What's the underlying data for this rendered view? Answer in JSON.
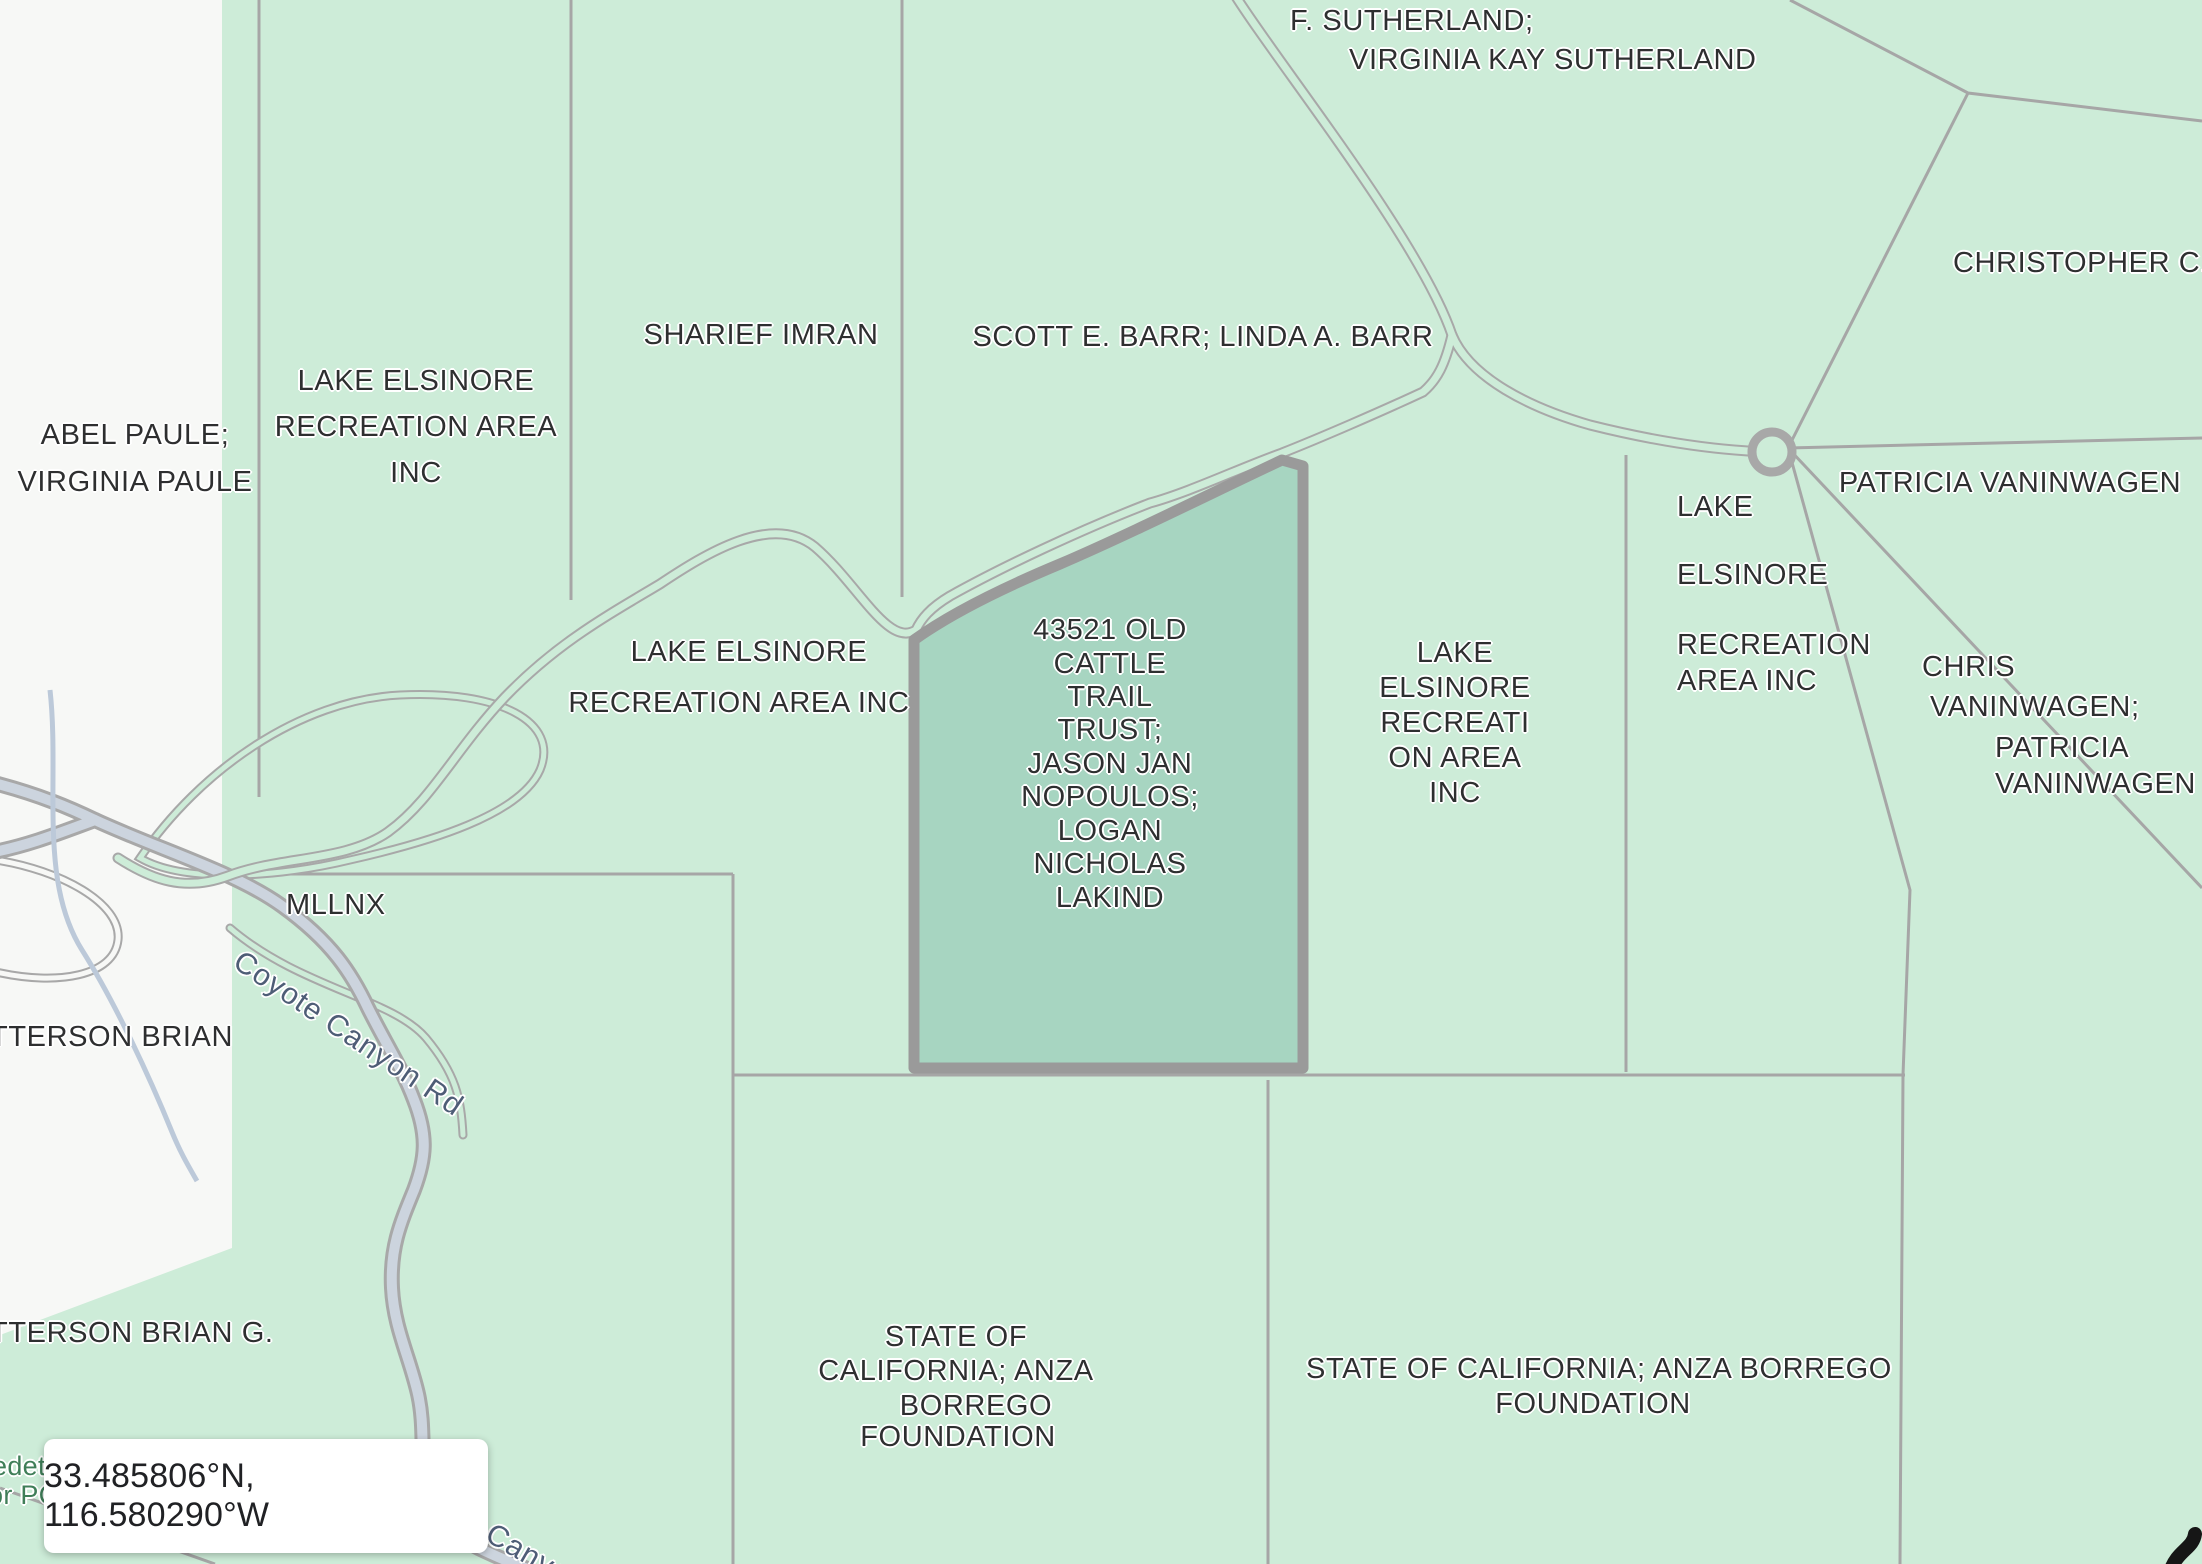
{
  "app": "parcel-map-viewer",
  "coordinate_chip": {
    "text": "33.485806°N, 116.580290°W"
  },
  "selected_parcel": {
    "owner": "43521 OLD CATTLE TRAIL TRUST; JASON JAN NOPOULOS; LOGAN NICHOLAS LAKIND",
    "fill": "#a7d5c1",
    "border": "#9a9a9a"
  },
  "palette": {
    "parcel_green": "#cdecd8",
    "unmapped_white": "#f7f8f6",
    "selected_teal": "#a7d5c1",
    "boundary_line": "#a6a6a6",
    "selected_border": "#9a9a9a",
    "road_fill": "#ccd4de",
    "label_text": "#2e2f30",
    "road_label_text": "#4e5d76",
    "green_label_text": "#3f7e58"
  },
  "road_names": [
    "Coyote Canyon Rd"
  ],
  "labels": [
    {
      "n": "parcel-label-sutherland-1",
      "t": "F. SUTHERLAND;",
      "x": 1290,
      "y": 6,
      "a": "l"
    },
    {
      "n": "parcel-label-sutherland-2",
      "t": "VIRGINIA KAY SUTHERLAND",
      "x": 1349,
      "y": 45,
      "a": "l"
    },
    {
      "n": "parcel-label-christopher",
      "t": "CHRISTOPHER C.",
      "x": 1953,
      "y": 248,
      "a": "l"
    },
    {
      "n": "parcel-label-abel-paule-1",
      "t": "ABEL PAULE;",
      "x": 135,
      "y": 420,
      "a": "c"
    },
    {
      "n": "parcel-label-abel-paule-2",
      "t": "VIRGINIA PAULE",
      "x": 135,
      "y": 467,
      "a": "c"
    },
    {
      "n": "parcel-label-lera-nw-1",
      "t": "LAKE ELSINORE",
      "x": 416,
      "y": 366,
      "a": "c"
    },
    {
      "n": "parcel-label-lera-nw-2",
      "t": "RECREATION AREA",
      "x": 416,
      "y": 412,
      "a": "c"
    },
    {
      "n": "parcel-label-lera-nw-3",
      "t": "INC",
      "x": 416,
      "y": 458,
      "a": "c"
    },
    {
      "n": "parcel-label-sharief-imran",
      "t": "SHARIEF IMRAN",
      "x": 761,
      "y": 320,
      "a": "c"
    },
    {
      "n": "parcel-label-scott-barr",
      "t": "SCOTT E. BARR; LINDA A. BARR",
      "x": 1203,
      "y": 322,
      "a": "c"
    },
    {
      "n": "parcel-label-patricia-vaninwagen",
      "t": "PATRICIA VANINWAGEN",
      "x": 2010,
      "y": 468,
      "a": "c"
    },
    {
      "n": "parcel-label-lera-e-1",
      "t": "LAKE",
      "x": 1677,
      "y": 492,
      "a": "l"
    },
    {
      "n": "parcel-label-lera-e-2",
      "t": "ELSINORE",
      "x": 1677,
      "y": 560,
      "a": "l"
    },
    {
      "n": "parcel-label-lera-e-3",
      "t": "RECREATION",
      "x": 1677,
      "y": 630,
      "a": "l"
    },
    {
      "n": "parcel-label-lera-e-4",
      "t": "AREA INC",
      "x": 1677,
      "y": 666,
      "a": "l"
    },
    {
      "n": "parcel-label-chris-vaninwagen-1",
      "t": "CHRIS",
      "x": 1922,
      "y": 652,
      "a": "l"
    },
    {
      "n": "parcel-label-chris-vaninwagen-2",
      "t": "VANINWAGEN;",
      "x": 1930,
      "y": 692,
      "a": "l"
    },
    {
      "n": "parcel-label-chris-vaninwagen-3",
      "t": "PATRICIA",
      "x": 1995,
      "y": 733,
      "a": "l"
    },
    {
      "n": "parcel-label-chris-vaninwagen-4",
      "t": "VANINWAGEN",
      "x": 1995,
      "y": 769,
      "a": "l"
    },
    {
      "n": "parcel-label-lera-mid-1",
      "t": "LAKE",
      "x": 1455,
      "y": 638,
      "a": "c"
    },
    {
      "n": "parcel-label-lera-mid-2",
      "t": "ELSINORE",
      "x": 1455,
      "y": 673,
      "a": "c"
    },
    {
      "n": "parcel-label-lera-mid-3",
      "t": "RECREATI",
      "x": 1455,
      "y": 708,
      "a": "c"
    },
    {
      "n": "parcel-label-lera-mid-4",
      "t": "ON AREA",
      "x": 1455,
      "y": 743,
      "a": "c"
    },
    {
      "n": "parcel-label-lera-mid-5",
      "t": "INC",
      "x": 1455,
      "y": 778,
      "a": "c"
    },
    {
      "n": "parcel-label-lera-w-1",
      "t": "LAKE ELSINORE",
      "x": 749,
      "y": 637,
      "a": "c"
    },
    {
      "n": "parcel-label-lera-w-2",
      "t": "RECREATION AREA INC",
      "x": 739,
      "y": 688,
      "a": "c"
    },
    {
      "n": "selected-parcel-label-1",
      "t": "43521 OLD",
      "x": 1110,
      "y": 615,
      "a": "c"
    },
    {
      "n": "selected-parcel-label-2",
      "t": "CATTLE",
      "x": 1110,
      "y": 649,
      "a": "c"
    },
    {
      "n": "selected-parcel-label-3",
      "t": "TRAIL",
      "x": 1110,
      "y": 682,
      "a": "c"
    },
    {
      "n": "selected-parcel-label-4",
      "t": "TRUST;",
      "x": 1110,
      "y": 715,
      "a": "c"
    },
    {
      "n": "selected-parcel-label-5",
      "t": "JASON JAN",
      "x": 1110,
      "y": 749,
      "a": "c"
    },
    {
      "n": "selected-parcel-label-6",
      "t": "NOPOULOS;",
      "x": 1110,
      "y": 782,
      "a": "c"
    },
    {
      "n": "selected-parcel-label-7",
      "t": "LOGAN",
      "x": 1110,
      "y": 816,
      "a": "c"
    },
    {
      "n": "selected-parcel-label-8",
      "t": "NICHOLAS",
      "x": 1110,
      "y": 849,
      "a": "c"
    },
    {
      "n": "selected-parcel-label-9",
      "t": "LAKIND",
      "x": 1110,
      "y": 883,
      "a": "c"
    },
    {
      "n": "parcel-label-mllnx",
      "t": "MLLNX",
      "x": 286,
      "y": 890,
      "a": "l"
    },
    {
      "n": "parcel-label-tterson-brian",
      "t": "TTERSON BRIAN",
      "x": -10,
      "y": 1022,
      "a": "l"
    },
    {
      "n": "parcel-label-tterson-brian-g",
      "t": "TTERSON BRIAN G.",
      "x": -10,
      "y": 1318,
      "a": "l"
    },
    {
      "n": "parcel-label-state-ca-w-1",
      "t": "STATE OF",
      "x": 956,
      "y": 1322,
      "a": "c"
    },
    {
      "n": "parcel-label-state-ca-w-2",
      "t": "CALIFORNIA; ANZA",
      "x": 956,
      "y": 1356,
      "a": "c"
    },
    {
      "n": "parcel-label-state-ca-w-3",
      "t": "BORREGO",
      "x": 976,
      "y": 1391,
      "a": "c"
    },
    {
      "n": "parcel-label-state-ca-w-4",
      "t": "FOUNDATION",
      "x": 958,
      "y": 1422,
      "a": "c"
    },
    {
      "n": "parcel-label-state-ca-e-1",
      "t": "STATE OF CALIFORNIA; ANZA BORREGO",
      "x": 1599,
      "y": 1354,
      "a": "c"
    },
    {
      "n": "parcel-label-state-ca-e-2",
      "t": "FOUNDATION",
      "x": 1593,
      "y": 1389,
      "a": "c"
    },
    {
      "n": "road-label-coyote-canyon",
      "t": "Coyote Canyon Rd",
      "x": 348,
      "y": 1018,
      "a": "c",
      "r": 34,
      "cls": "roadlabel"
    },
    {
      "n": "road-label-coyote-canyon-2",
      "t": "e Canyo",
      "x": 516,
      "y": 1532,
      "a": "c",
      "r": 30,
      "cls": "roadlabel"
    },
    {
      "n": "green-area-label-1",
      "t": "edet",
      "x": -8,
      "y": 1452,
      "a": "l",
      "cls": "greenlabel"
    },
    {
      "n": "green-area-label-2",
      "t": "or PO",
      "x": -12,
      "y": 1481,
      "a": "l",
      "cls": "greenlabel"
    }
  ]
}
